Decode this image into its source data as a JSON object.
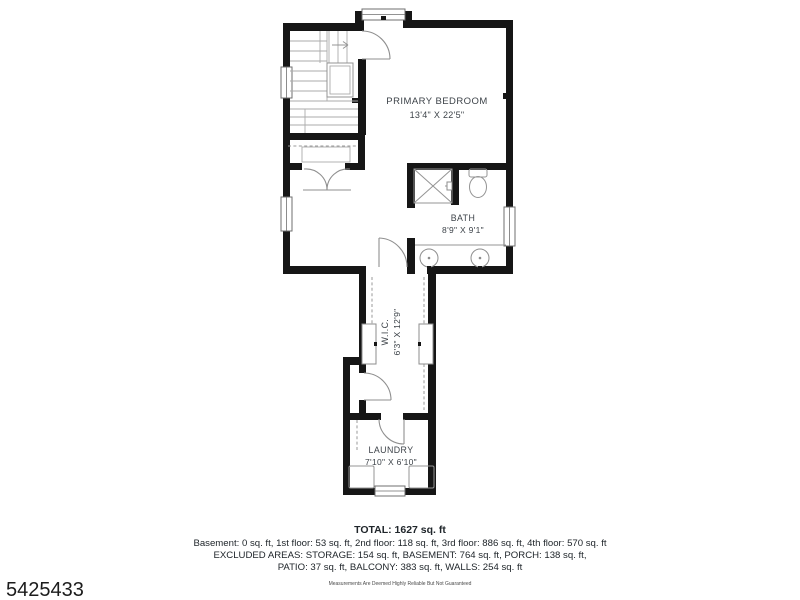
{
  "listing_id": "5425433",
  "disclaimer": "Measurements Are Deemed Highly Reliable But Not Guaranteed",
  "summary": {
    "total": "TOTAL: 1627 sq. ft",
    "floors": "Basement: 0 sq. ft, 1st floor: 53 sq. ft, 2nd floor: 118 sq. ft, 3rd floor: 886 sq. ft, 4th floor: 570 sq. ft",
    "excluded_line1": "EXCLUDED AREAS: STORAGE: 154 sq. ft, BASEMENT: 764 sq. ft, PORCH: 138 sq. ft,",
    "excluded_line2": "PATIO: 37 sq. ft, BALCONY: 383 sq. ft, WALLS: 254 sq. ft"
  },
  "rooms": {
    "primary_bedroom": {
      "name": "PRIMARY BEDROOM",
      "dims": "13'4\" X 22'5\""
    },
    "bath": {
      "name": "BATH",
      "dims": "8'9\" X 9'1\""
    },
    "wic": {
      "name": "W.I.C.",
      "dims": "6'3\" X 12'9\""
    },
    "laundry": {
      "name": "LAUNDRY",
      "dims": "7'10\" X 6'10\""
    }
  },
  "colors": {
    "wall": "#161616",
    "fixture_line": "#949494",
    "label_text": "#3d4349",
    "footer_text": "#20262b",
    "background": "#ffffff"
  }
}
